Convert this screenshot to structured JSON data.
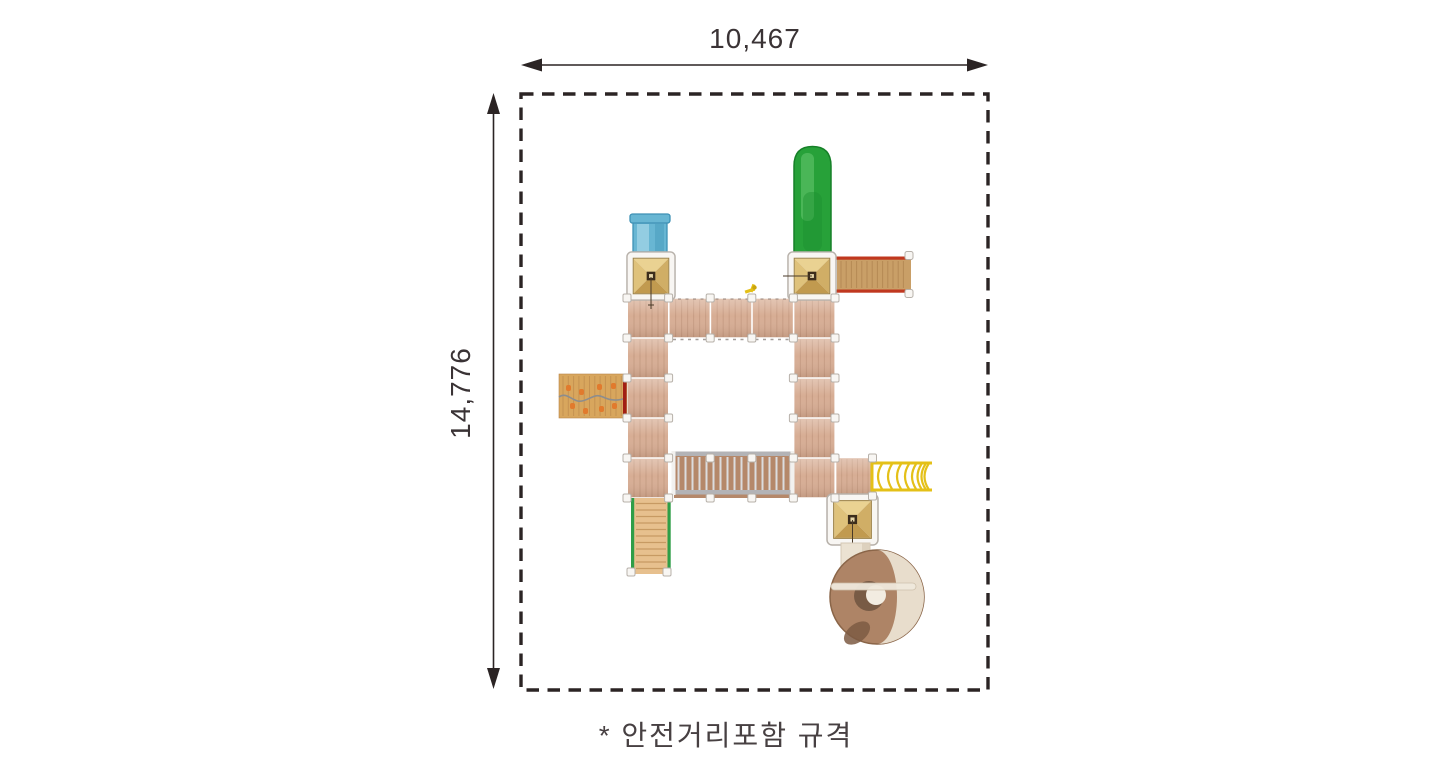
{
  "dimensions": {
    "top": "10,467",
    "left": "14,776"
  },
  "note": {
    "text": "* 안전거리포함 규격"
  },
  "palette": {
    "border": "#2b2424",
    "dim_line": "#2b2424",
    "dim_text": "#3a3335",
    "note_text": "#474042",
    "deck": "#d7ad94",
    "deck_line": "#b98e74",
    "frame_white": "#f8f6f3",
    "frame_stroke": "#b7b1aa",
    "roof_top": "#ead292",
    "roof_left": "#dfc27b",
    "roof_right": "#d0ae66",
    "roof_bottom": "#c19a4f",
    "roof_core": "#3c2d1c",
    "roof_core_dot": "#e6d6a8",
    "slide_blue": "#68b6d3",
    "slide_blue_dark": "#3e91b5",
    "slide_blue_light": "#9ed3e6",
    "slide_green": "#27a139",
    "slide_green_dark": "#168028",
    "slide_green_light": "#63c46d",
    "ramp_wood": "#c99f67",
    "ramp_line": "#a87c49",
    "rail_red": "#c0381f",
    "climb_wood": "#d8a65d",
    "climb_line": "#b9854a",
    "hold_orange": "#e17a2d",
    "rope_gray": "#8d8d8d",
    "bridge_wood": "#b5886a",
    "bridge_slat": "#dcdcde",
    "bridge_rail": "#b3b3b6",
    "bridge_cap": "#f2f1ef",
    "stair_wood": "#e7c08e",
    "stair_line": "#c79a63",
    "rail_green": "#2f9e47",
    "bars_yellow": "#e4c018",
    "spiral_brown": "#ae8466",
    "spiral_brown_dark": "#8a6548",
    "spiral_cream": "#ebe2d2",
    "spiral_hole": "#f2ece1",
    "spiral_shadow": "#6f5340"
  }
}
